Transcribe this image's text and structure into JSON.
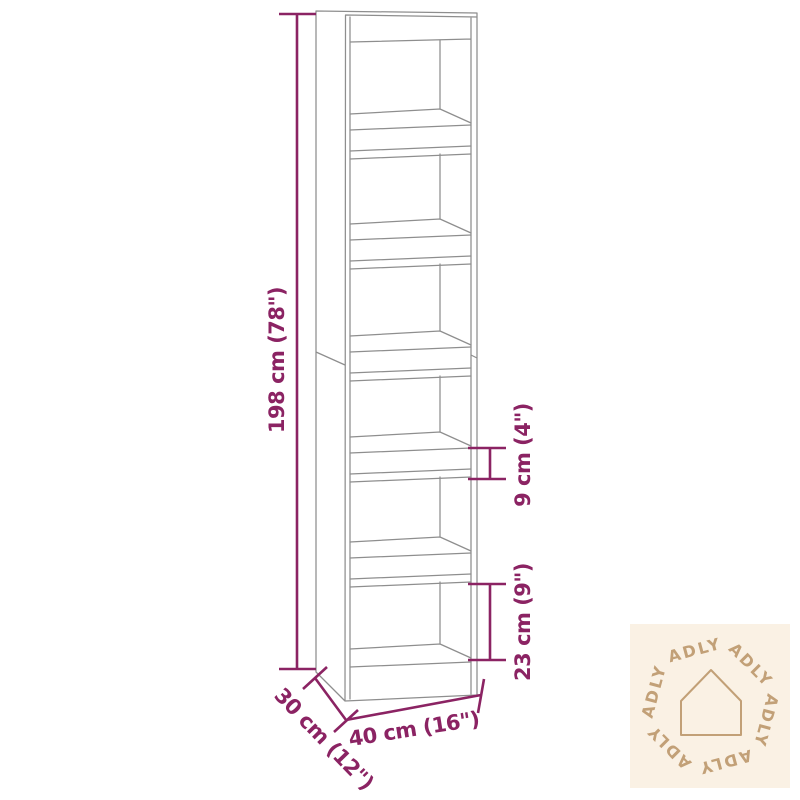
{
  "page": {
    "background": "#ffffff"
  },
  "diagram": {
    "type": "furniture-dimension-diagram",
    "product": "tall bookcase / room divider with 6 open compartments",
    "labels": {
      "height": "198 cm (78\")",
      "width": "40 cm (16\")",
      "depth": "30 cm (12\")",
      "shelf": "9 cm (4\")",
      "bottom_compartment": "23 cm (9\")"
    },
    "colors": {
      "dimension_lines": "#8B2363",
      "line_art": "#8E8E8E",
      "background": "#FFFFFF"
    }
  },
  "watermark": {
    "brand": "ADLY",
    "word_count": 6,
    "icon": "house-outline-icon",
    "colors": {
      "background": "#FAF1E4",
      "foreground": "#C2A077"
    }
  }
}
